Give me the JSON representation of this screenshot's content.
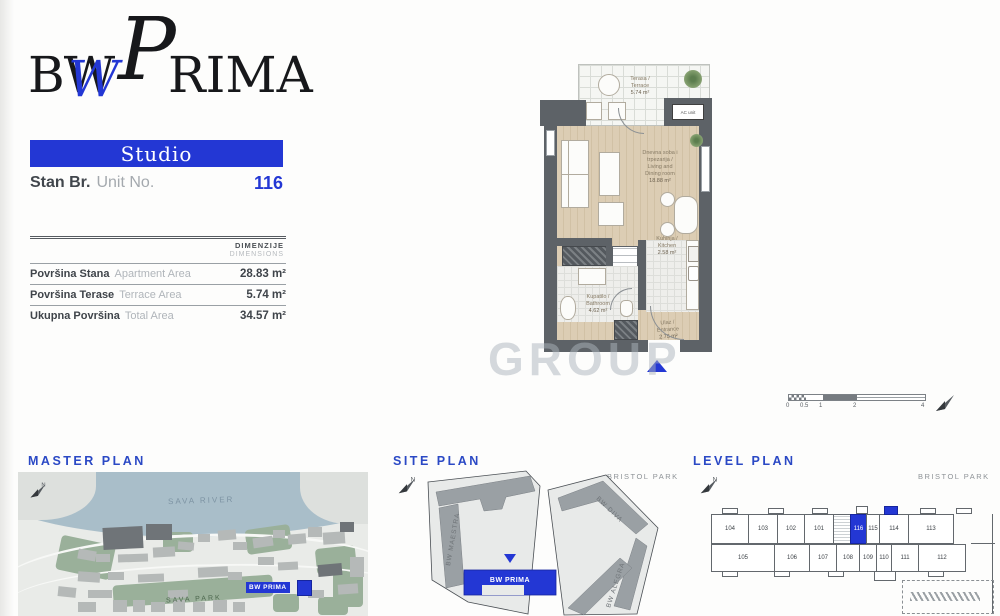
{
  "accent": "#2337d4",
  "logo": {
    "bw": "BW",
    "w_script": "W",
    "p_script": "P",
    "rima": "RIMA"
  },
  "unit": {
    "type": "Studio",
    "label_sr": "Stan Br.",
    "label_en": "Unit No.",
    "number": "116"
  },
  "dims": {
    "header_sr": "DIMENZIJE",
    "header_en": "DIMENSIONS",
    "rows": [
      {
        "sr": "Površina Stana",
        "en": "Apartment Area",
        "value": "28.83 m²"
      },
      {
        "sr": "Površina Terase",
        "en": "Terrace Area",
        "value": "5.74 m²"
      },
      {
        "sr": "Ukupna Površina",
        "en": "Total Area",
        "value": "34.57 m²"
      }
    ]
  },
  "plan": {
    "terrace": {
      "sr": "Terasa /",
      "en": "Terrace",
      "area": "5.74 m²"
    },
    "living": {
      "l1": "Dnevna soba i",
      "l2": "trpezarija /",
      "l3": "Living and",
      "l4": "Dining room",
      "area": "18.88 m²"
    },
    "kitchen": {
      "sr": "Kuhinja /",
      "en": "Kitchen",
      "area": "2.58 m²"
    },
    "bathroom": {
      "sr": "Kupatilo /",
      "en": "Bathroom",
      "area": "4.62 m²"
    },
    "entrance": {
      "sr": "Ulaz /",
      "en": "Entrance",
      "area": "2.75 m²"
    },
    "ac_unit": "AC unit"
  },
  "watermark": "GROUP",
  "scale": {
    "ticks": [
      "0",
      "0.5",
      "1",
      "2",
      "4"
    ]
  },
  "master_plan": {
    "title": "MASTER PLAN",
    "river": "SAVA RIVER",
    "park": "SAVA PARK",
    "highlight": "BW PRIMA"
  },
  "site_plan": {
    "title": "SITE PLAN",
    "park": "BRISTOL PARK",
    "maestra": "BW MAESTRA",
    "diva": "BW DIVA",
    "alegra": "BW ALEGRA",
    "highlight": "BW PRIMA"
  },
  "level_plan": {
    "title": "LEVEL PLAN",
    "park": "BRISTOL PARK",
    "units_top": [
      "104",
      "103",
      "102",
      "101"
    ],
    "unit_highlight": "116",
    "units_top_right": [
      "115",
      "114",
      "113"
    ],
    "units_bottom": [
      "105",
      "106",
      "107",
      "108",
      "109",
      "110",
      "111",
      "112"
    ]
  }
}
